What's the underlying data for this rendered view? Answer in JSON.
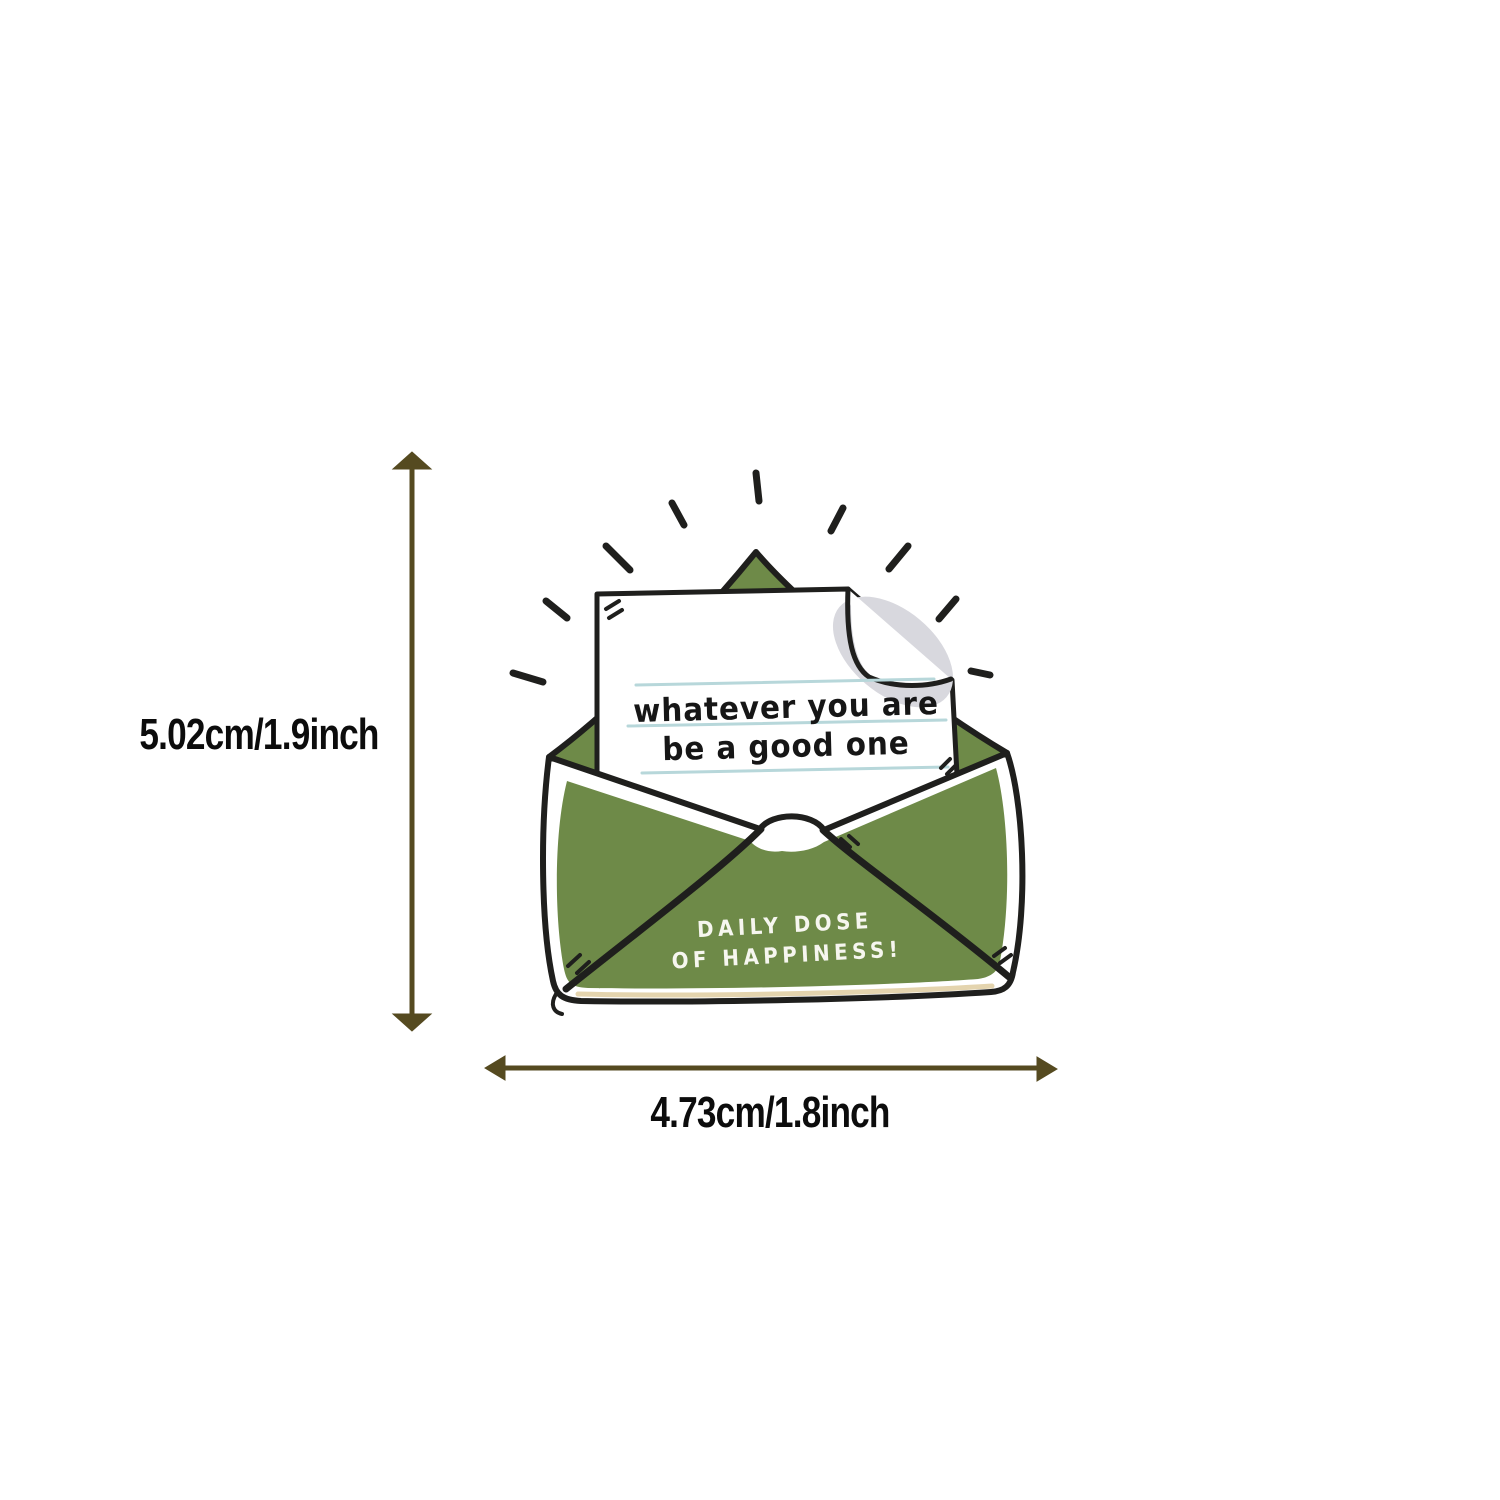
{
  "figure": {
    "height_label": "5.02cm/1.9inch",
    "width_label": "4.73cm/1.8inch"
  },
  "sticker": {
    "letter_line1": "whatever you are",
    "letter_line2": "be a good one",
    "envelope_line1": "DAILY DOSE",
    "envelope_line2": "OF HAPPINESS!"
  },
  "colors": {
    "background": "#ffffff",
    "ink": "#1f1f1d",
    "green": "#6e8a48",
    "dimension": "#554a20",
    "label_text": "#0c0c0c",
    "letter_text": "#161616",
    "envelope_text": "#f6f6ef",
    "curl_shadow": "#d8d8de",
    "ruled_line": "#b7d7da",
    "bottom_tint": "#e4d4ae"
  }
}
